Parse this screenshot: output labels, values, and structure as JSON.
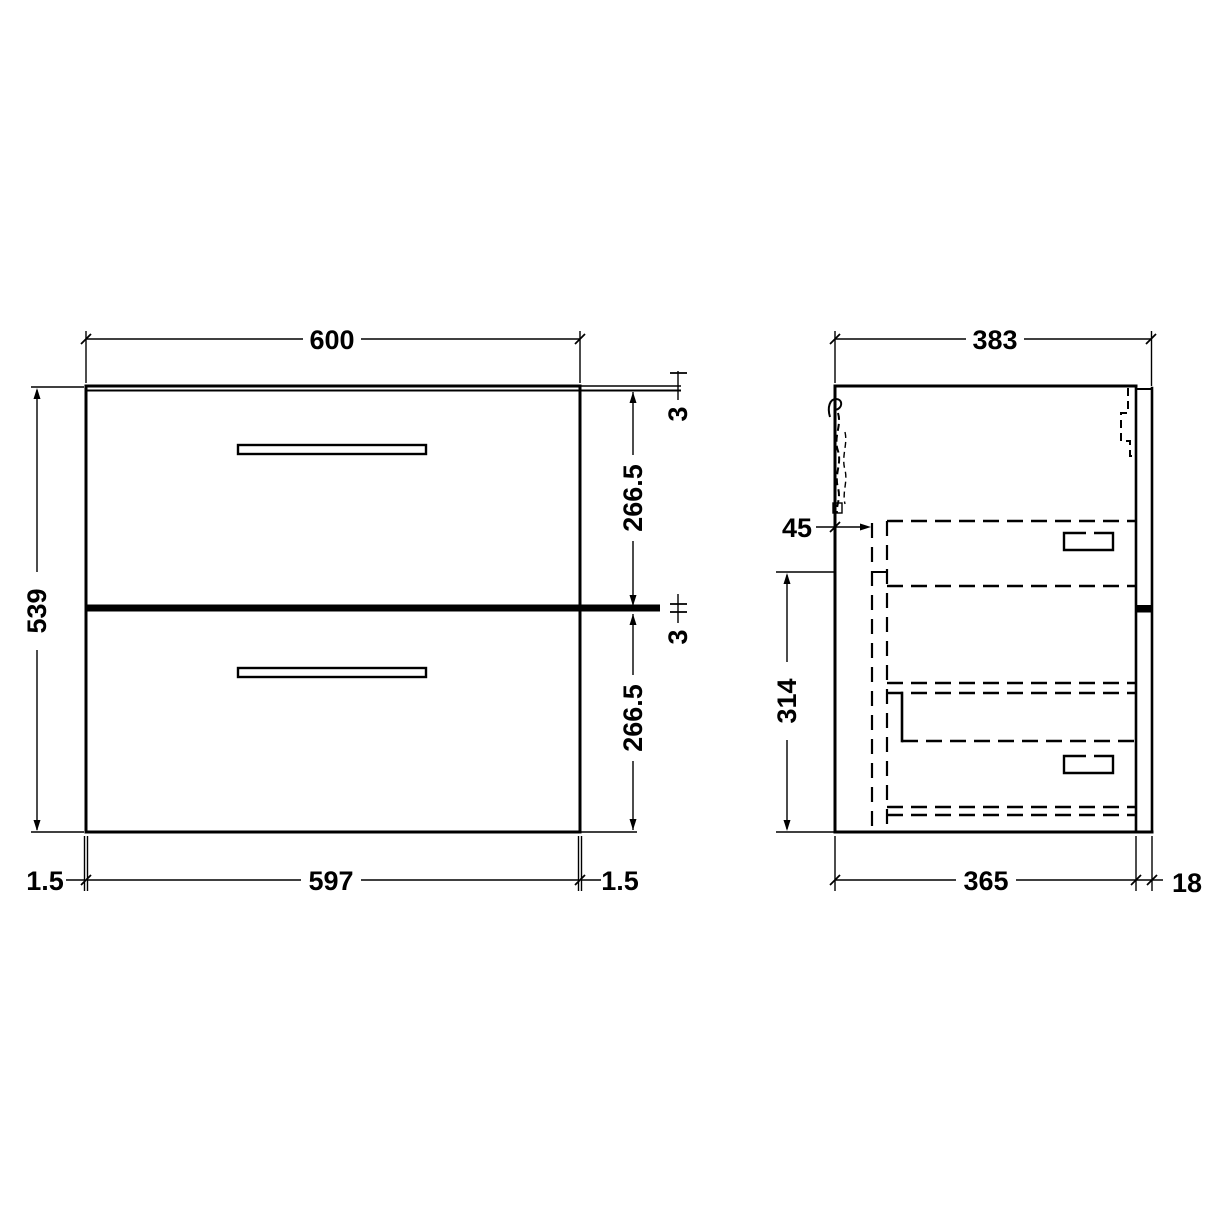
{
  "front": {
    "width_top": "600",
    "height": "539",
    "top_panel_thickness": "3",
    "upper_drawer_height": "266.5",
    "drawer_gap": "3",
    "lower_drawer_height": "266.5",
    "width_bottom": "597",
    "side_gap_left": "1.5",
    "side_gap_right": "1.5"
  },
  "side": {
    "depth_top": "383",
    "back_clearance": "45",
    "lower_section_height": "314",
    "carcass_depth": "365",
    "front_panel_thickness": "18"
  },
  "colors": {
    "line": "#000000",
    "background": "#ffffff"
  }
}
